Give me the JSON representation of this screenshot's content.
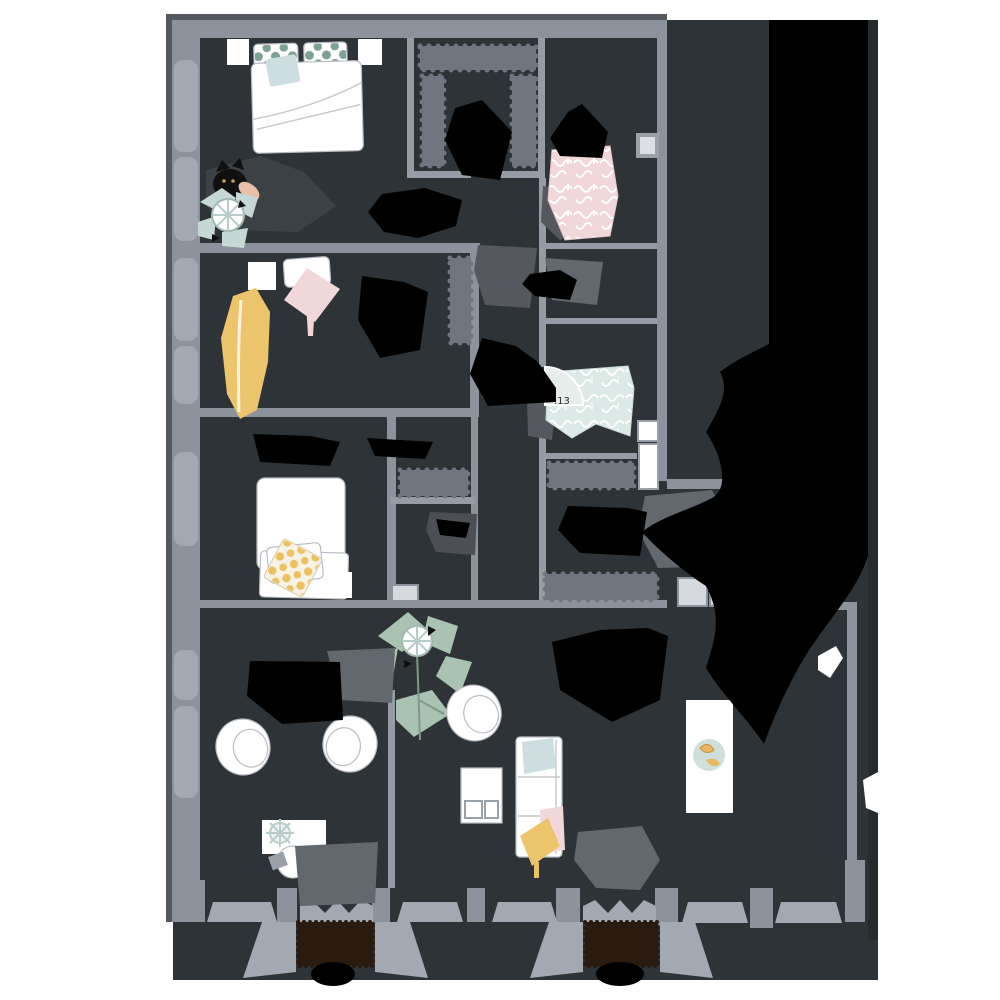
{
  "labels": {
    "room_number": ".13"
  },
  "palette": {
    "background": "#ffffff",
    "floor": "#2d3336",
    "wall": "#8d939d",
    "wall_shadow": "#55595f",
    "window": "#a3a9b3",
    "radiator": "#70767f",
    "shadow_black": "#000000",
    "shadow_gray": "#63686e",
    "furniture_white": "#ffffff",
    "furniture_outline": "#b9bdc3",
    "teal_polka_dot": "#7ba294",
    "blue_cushion": "#ccdee0",
    "pink_fabric": "#f1d7da",
    "blue_fabric": "#dde9e7",
    "yellow_beanbag": "#ecc46b",
    "yellow_polka_dot": "#eec05f",
    "plant_green": "#a9c3b2",
    "plant_blue": "#c5d8d5",
    "plate_teal": "#cfe0db",
    "banana_yellow": "#eab95f",
    "dark_armchair": "#3c4146",
    "cat_black": "#101010",
    "skin_peach": "#e8c0a8",
    "door_mat_brown": "#2b1a0e",
    "door_panel": "#d6d9de"
  }
}
